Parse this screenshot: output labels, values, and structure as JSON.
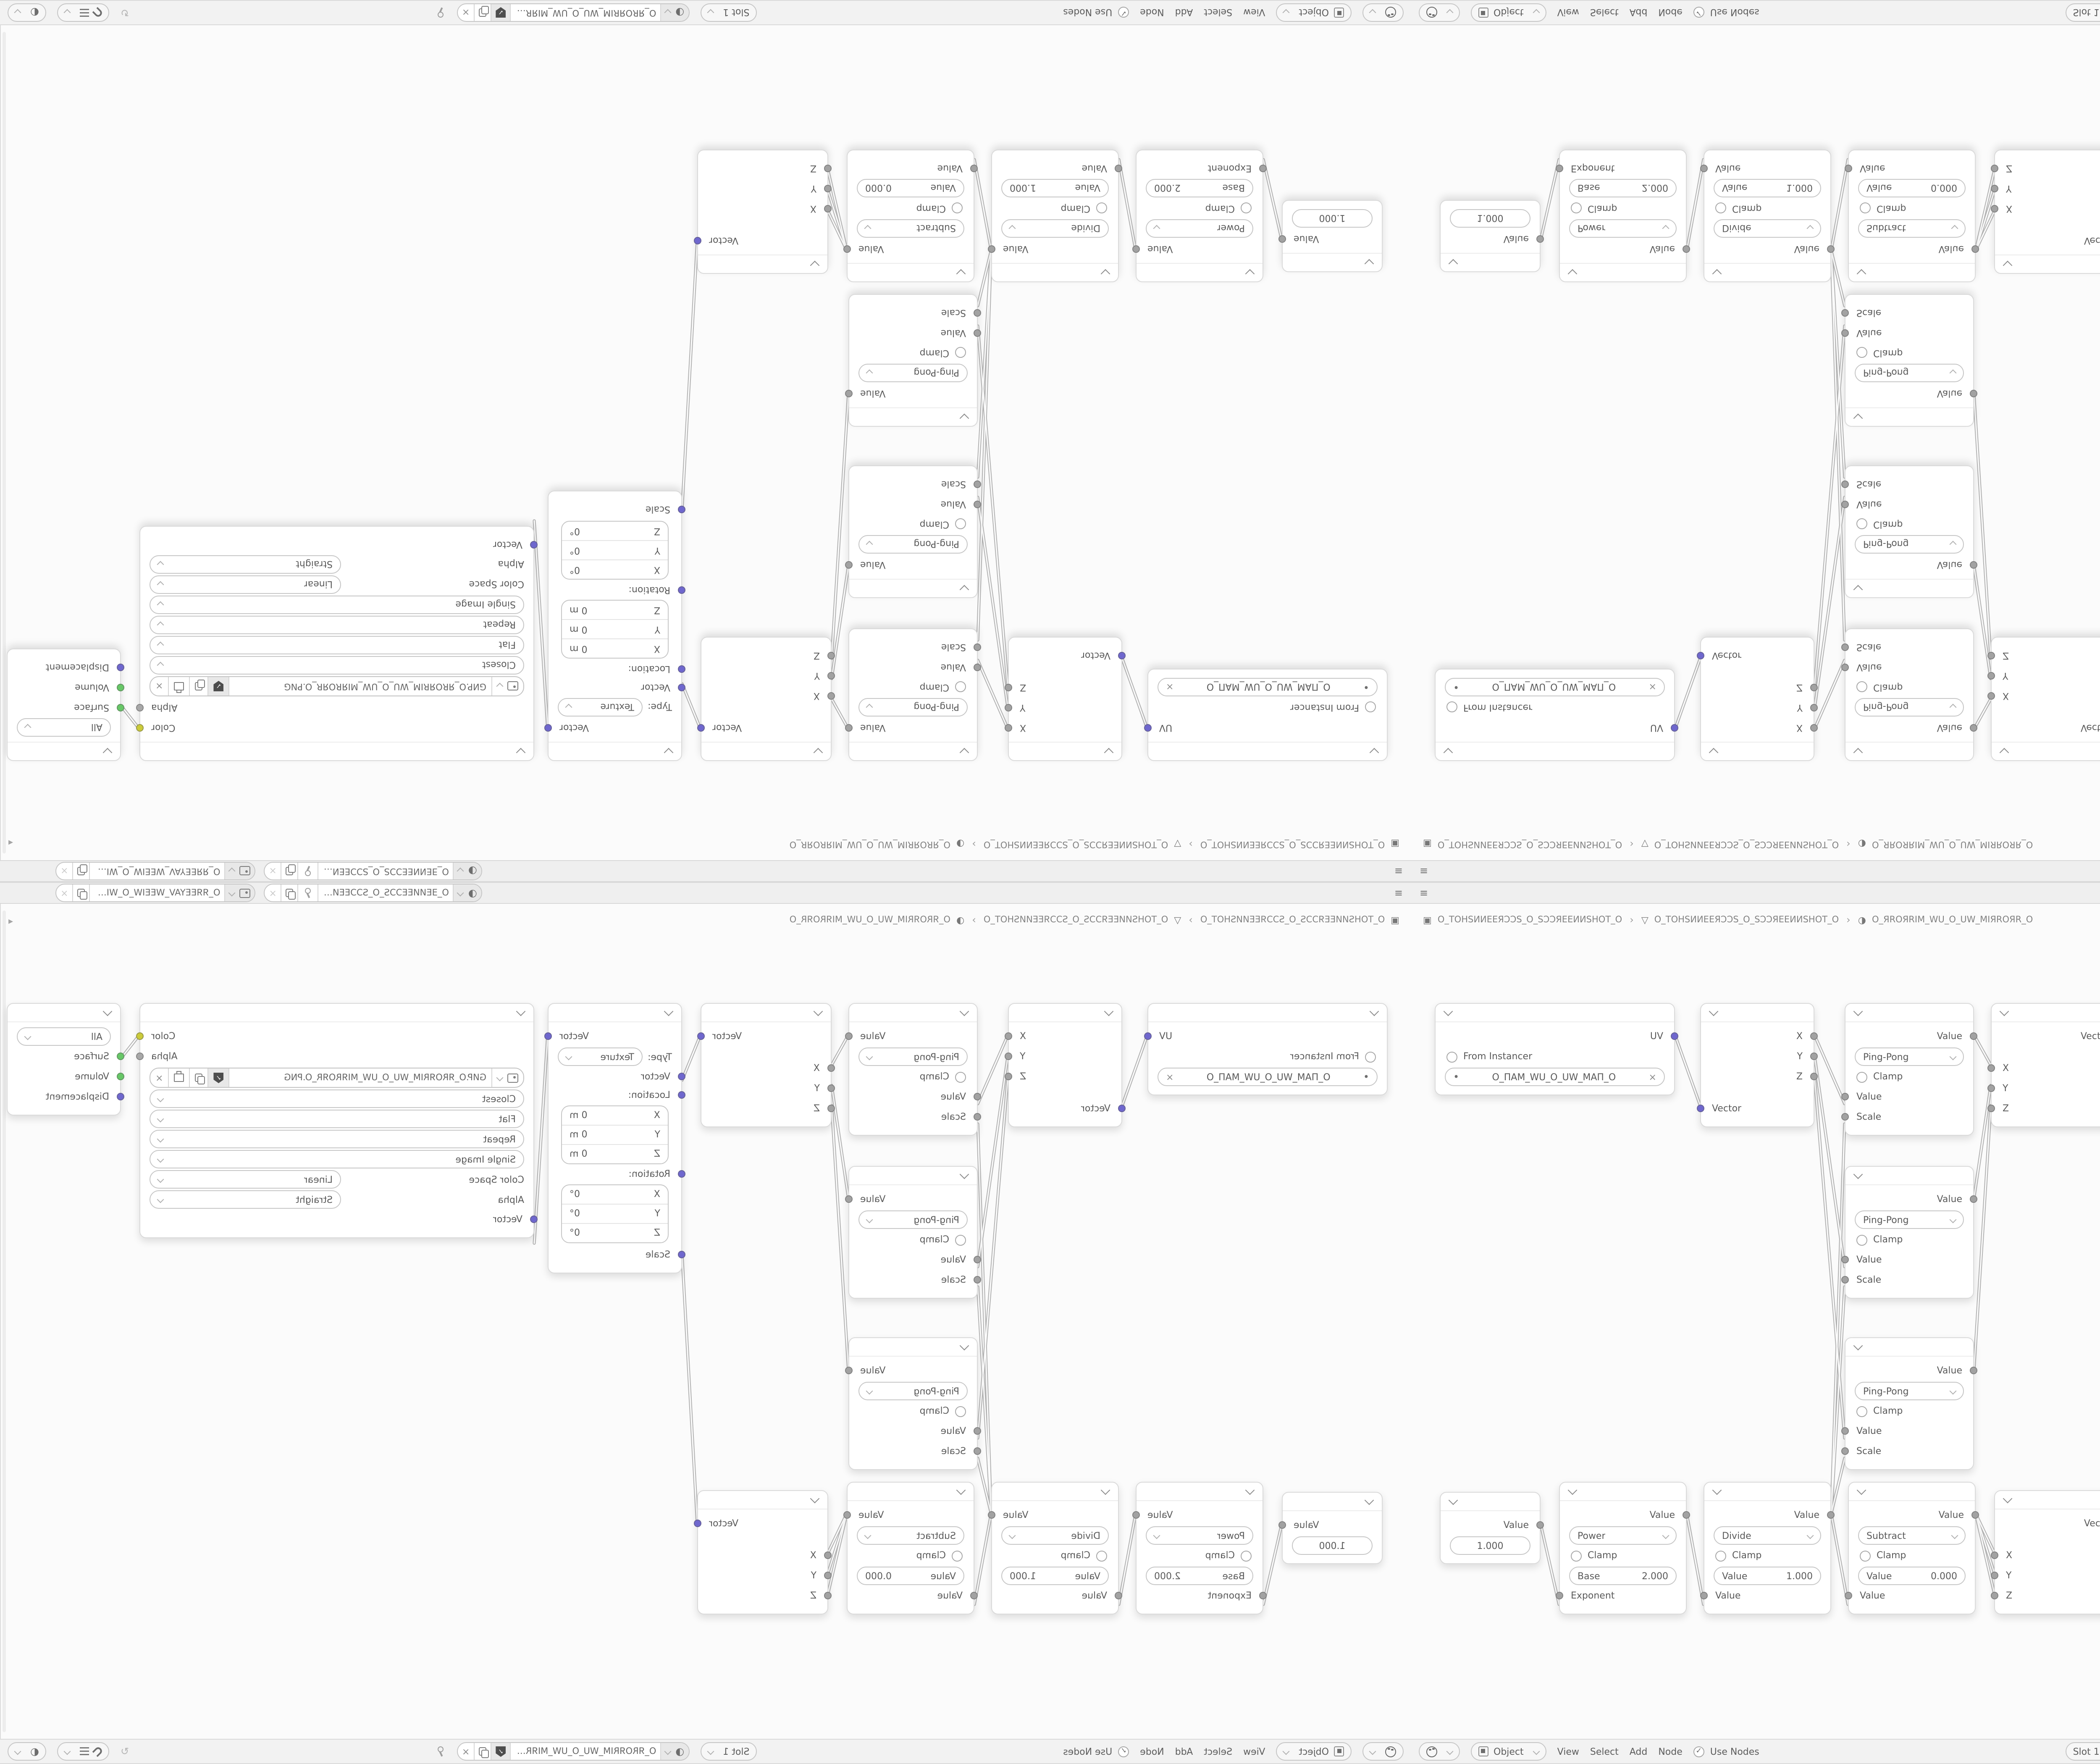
{
  "colors": {
    "canvas": "#fbfbfb",
    "panel": "#f1f1f1",
    "node_bg": "#ffffff",
    "wire": "#b2b2b2",
    "text": "#5a5a5a",
    "socket_value": "#a2a2a2",
    "socket_vector": "#6f67ce",
    "socket_color": "#cbcb3a",
    "socket_shader": "#67c767"
  },
  "icons": {
    "check": "✓",
    "close": "×",
    "hamburger": "≡",
    "refresh": "↻",
    "overlay_sphere": "◐",
    "material_sphere": "◑",
    "screen": "▣",
    "mesh": "▽",
    "layers": "▤",
    "dot": "•",
    "sidebar_arrow": "◂",
    "crumb_sep": "›"
  },
  "header_bar": {
    "shader_type": "Object",
    "menus": [
      "View",
      "Select",
      "Add",
      "Node"
    ],
    "use_nodes": "Use Nodes",
    "slot": "Slot 1",
    "material": "O_ЯROЯRIM_WU_O_UW_MIЯROЯR_O"
  },
  "topbar": {
    "scene": "O_ƎEИИEEƆƆS_O_SƆƆEEИИEƎ_O",
    "view_layer": "O_ЯЯEEYAV_WEEIW_O_WIEEW_VAYEEЯЯ_O"
  },
  "breadcrumb": {
    "items": [
      {
        "label": "O_TOHSИИEEЯƆƆS_O_SƆƆЯEEИИSHOT_O"
      },
      {
        "label": "O_TOHSИИEEЯƆƆS_O_SƆƆЯEEИИSHOT_O"
      },
      {
        "label": "O_ЯROЯRIM_WU_O_UW_MIЯROЯR_O"
      }
    ]
  },
  "nodes": {
    "uv": {
      "out": "UV",
      "from_instancer": "From Instancer",
      "map": "O_ПAM_WU_O_UW_MAП_O"
    },
    "separate": {
      "x": "X",
      "y": "Y",
      "z": "Z",
      "input": "Vector"
    },
    "pingpong": {
      "out": "Value",
      "op": "Ping-Pong",
      "clamp": "Clamp",
      "in_value": "Value",
      "in_scale": "Scale"
    },
    "combine": {
      "out": "Vector",
      "x": "X",
      "y": "Y",
      "z": "Z"
    },
    "mapping": {
      "out": "Vector",
      "type_label": "Type:",
      "type": "Texture",
      "in_vector": "Vector",
      "loc_label": "Location:",
      "rot_label": "Rotation:",
      "scale_label": "Scale",
      "x": "X",
      "y": "Y",
      "z": "Z",
      "loc_val": "0 m",
      "rot_val": "0°"
    },
    "image": {
      "out_color": "Color",
      "out_alpha": "Alpha",
      "filename": "GИP.O_ЯROЯRIM_WU_O_UW_MIЯROЯR_O.PNG",
      "interpolation": "Closest",
      "projection": "Flat",
      "extension": "Repeat",
      "source": "Single Image",
      "cs_label": "Color Space",
      "cs": "Linear",
      "alpha_label": "Alpha",
      "alpha": "Straight",
      "in_vector": "Vector"
    },
    "output": {
      "target": "All",
      "surface": "Surface",
      "volume": "Volume",
      "displacement": "Displacement"
    },
    "value": {
      "out": "Value",
      "value": "1.000"
    },
    "power": {
      "out": "Value",
      "op": "Power",
      "clamp": "Clamp",
      "field_label": "Base",
      "field_value": "2.000",
      "input": "Exponent"
    },
    "divide": {
      "out": "Value",
      "op": "Divide",
      "clamp": "Clamp",
      "field_label": "Value",
      "field_value": "1.000",
      "input": "Value"
    },
    "subtract": {
      "out": "Value",
      "op": "Subtract",
      "clamp": "Clamp",
      "field_label": "Value",
      "field_value": "0.000",
      "input": "Value"
    }
  }
}
